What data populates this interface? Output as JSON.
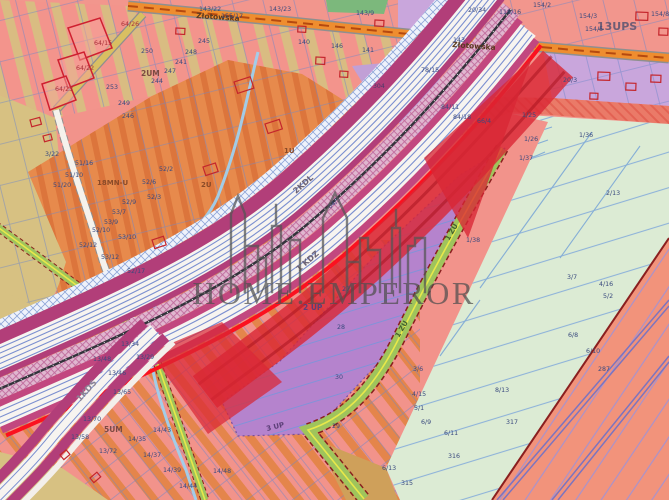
{
  "watermark": {
    "brand": "HOME.EMPEROR"
  },
  "map": {
    "street": {
      "name": "Złotowska"
    },
    "legend_colors": {
      "residential_pink": "#f2938b",
      "stripe_tan": "#d9bc82",
      "stripe_orange": "#e2823f",
      "services_orange": "#e78a4c",
      "zone_purple": "#b583cd",
      "zone_purple_light": "#c9a6dc",
      "greenery": "#dcebd4",
      "green_road": "#9fc45c",
      "agric_salmon": "#f2937b",
      "rail_magenta": "#b23e79",
      "road_white": "#f7f4f0",
      "planned_red": "#d92734",
      "street_orange": "#ef8d2f",
      "parcel_blue": "#6e86c8",
      "tan_zone": "#d7c182"
    },
    "zone_labels": [
      {
        "t": "13UPS",
        "x": 597,
        "y": 30,
        "s": 11,
        "c": "#6f5d75",
        "b": 1
      },
      {
        "t": "2UM",
        "x": 141,
        "y": 76,
        "s": 7.5,
        "c": "#7c4a42",
        "b": 1
      },
      {
        "t": "5UM",
        "x": 104,
        "y": 432,
        "s": 7.5,
        "c": "#7c4a42",
        "b": 1
      },
      {
        "t": "18MN-U",
        "x": 97,
        "y": 185,
        "s": 7,
        "c": "#8a4a28",
        "b": 1
      },
      {
        "t": "1U",
        "x": 284,
        "y": 153,
        "s": 7,
        "c": "#8a4a28",
        "b": 1
      },
      {
        "t": "2U",
        "x": 201,
        "y": 187,
        "s": 7,
        "c": "#8a4a28",
        "b": 1
      },
      {
        "t": "2 UP",
        "x": 303,
        "y": 310,
        "s": 7.5,
        "c": "#5c3f78",
        "b": 1
      },
      {
        "t": "3 UP",
        "x": 267,
        "y": 431,
        "s": 7,
        "c": "#5c3f78",
        "b": 1,
        "r": -14
      },
      {
        "t": "304",
        "x": 373,
        "y": 88,
        "s": 6.2,
        "c": "#4a3a6a"
      },
      {
        "t": "2KDL",
        "x": 296,
        "y": 194,
        "s": 8,
        "c": "#6b6275",
        "b": 1,
        "r": -41
      },
      {
        "t": "1 KDZ",
        "x": 299,
        "y": 272,
        "s": 8,
        "c": "#6b6275",
        "b": 1,
        "r": -41
      },
      {
        "t": "1KDS",
        "x": 80,
        "y": 402,
        "s": 8.5,
        "c": "#8a8494",
        "b": 1,
        "r": -48
      },
      {
        "t": "1 ZU",
        "x": 449,
        "y": 241,
        "s": 7,
        "c": "#44622e",
        "b": 1,
        "r": -60
      },
      {
        "t": "1 ZU",
        "x": 399,
        "y": 338,
        "s": 7,
        "c": "#44622e",
        "b": 1,
        "r": -60
      },
      {
        "t": "Złotowska",
        "x": 196,
        "y": 18,
        "s": 7.5,
        "c": "#5a3a20",
        "r": 4,
        "b": 1
      },
      {
        "t": "Złotowska",
        "x": 452,
        "y": 47,
        "s": 7.5,
        "c": "#5a3a20",
        "r": 4,
        "b": 1
      }
    ],
    "parcel_labels": [
      {
        "t": "64/26",
        "x": 121,
        "y": 26,
        "c": "#a83038"
      },
      {
        "t": "64/15",
        "x": 94,
        "y": 45,
        "c": "#a83038"
      },
      {
        "t": "64/22",
        "x": 76,
        "y": 70,
        "c": "#a83038"
      },
      {
        "t": "64/23",
        "x": 55,
        "y": 91,
        "c": "#a83038"
      },
      {
        "t": "250",
        "x": 141,
        "y": 53
      },
      {
        "t": "245",
        "x": 198,
        "y": 43
      },
      {
        "t": "248",
        "x": 185,
        "y": 54
      },
      {
        "t": "241",
        "x": 175,
        "y": 64
      },
      {
        "t": "247",
        "x": 164,
        "y": 73
      },
      {
        "t": "244",
        "x": 151,
        "y": 83
      },
      {
        "t": "253",
        "x": 106,
        "y": 89
      },
      {
        "t": "249",
        "x": 118,
        "y": 105
      },
      {
        "t": "246",
        "x": 122,
        "y": 118
      },
      {
        "t": "143/22",
        "x": 199,
        "y": 11
      },
      {
        "t": "143/23",
        "x": 269,
        "y": 11
      },
      {
        "t": "155/17",
        "x": 221,
        "y": 18
      },
      {
        "t": "143/9",
        "x": 356,
        "y": 15
      },
      {
        "t": "20/34",
        "x": 468,
        "y": 12
      },
      {
        "t": "118/16",
        "x": 499,
        "y": 14
      },
      {
        "t": "154/2",
        "x": 533,
        "y": 7
      },
      {
        "t": "154/3",
        "x": 579,
        "y": 18
      },
      {
        "t": "154/5",
        "x": 585,
        "y": 31
      },
      {
        "t": "154/8",
        "x": 651,
        "y": 16
      },
      {
        "t": "140",
        "x": 298,
        "y": 44
      },
      {
        "t": "146",
        "x": 331,
        "y": 48
      },
      {
        "t": "141",
        "x": 362,
        "y": 52
      },
      {
        "t": "143",
        "x": 453,
        "y": 42
      },
      {
        "t": "78/15",
        "x": 421,
        "y": 72
      },
      {
        "t": "84/18",
        "x": 453,
        "y": 119
      },
      {
        "t": "84/11",
        "x": 441,
        "y": 109
      },
      {
        "t": "66/4",
        "x": 477,
        "y": 123
      },
      {
        "t": "20/3",
        "x": 563,
        "y": 82
      },
      {
        "t": "84/5",
        "x": 330,
        "y": 209,
        "r": -41
      },
      {
        "t": "1/25",
        "x": 522,
        "y": 117
      },
      {
        "t": "1/26",
        "x": 524,
        "y": 141
      },
      {
        "t": "1/37",
        "x": 519,
        "y": 160
      },
      {
        "t": "1/36",
        "x": 579,
        "y": 137
      },
      {
        "t": "2/13",
        "x": 606,
        "y": 195
      },
      {
        "t": "1/38",
        "x": 466,
        "y": 242
      },
      {
        "t": "3/7",
        "x": 567,
        "y": 279
      },
      {
        "t": "4/16",
        "x": 599,
        "y": 286
      },
      {
        "t": "5/2",
        "x": 603,
        "y": 298
      },
      {
        "t": "6/8",
        "x": 568,
        "y": 337
      },
      {
        "t": "6/10",
        "x": 586,
        "y": 353
      },
      {
        "t": "287",
        "x": 598,
        "y": 371
      },
      {
        "t": "3/6",
        "x": 413,
        "y": 371
      },
      {
        "t": "4/15",
        "x": 412,
        "y": 396
      },
      {
        "t": "5/1",
        "x": 414,
        "y": 410
      },
      {
        "t": "6/9",
        "x": 421,
        "y": 424
      },
      {
        "t": "6/11",
        "x": 444,
        "y": 435
      },
      {
        "t": "317",
        "x": 506,
        "y": 424
      },
      {
        "t": "316",
        "x": 448,
        "y": 458
      },
      {
        "t": "315",
        "x": 401,
        "y": 485
      },
      {
        "t": "6/13",
        "x": 382,
        "y": 470
      },
      {
        "t": "8/13",
        "x": 495,
        "y": 392
      },
      {
        "t": "27",
        "x": 342,
        "y": 291
      },
      {
        "t": "28",
        "x": 337,
        "y": 329
      },
      {
        "t": "30",
        "x": 335,
        "y": 379
      },
      {
        "t": "29",
        "x": 332,
        "y": 428
      },
      {
        "t": "13/46",
        "x": 108,
        "y": 375
      },
      {
        "t": "13/65",
        "x": 113,
        "y": 394
      },
      {
        "t": "13/48",
        "x": 93,
        "y": 361
      },
      {
        "t": "13/70",
        "x": 83,
        "y": 421
      },
      {
        "t": "13/72",
        "x": 99,
        "y": 453
      },
      {
        "t": "13/58",
        "x": 71,
        "y": 439
      },
      {
        "t": "14/43",
        "x": 153,
        "y": 432
      },
      {
        "t": "14/35",
        "x": 128,
        "y": 441
      },
      {
        "t": "14/37",
        "x": 143,
        "y": 457
      },
      {
        "t": "14/39",
        "x": 163,
        "y": 472
      },
      {
        "t": "14/44",
        "x": 179,
        "y": 488
      },
      {
        "t": "14/48",
        "x": 213,
        "y": 473
      },
      {
        "t": "13/34",
        "x": 121,
        "y": 346
      },
      {
        "t": "13/29",
        "x": 136,
        "y": 359
      },
      {
        "t": "52/2",
        "x": 159,
        "y": 171
      },
      {
        "t": "52/6",
        "x": 142,
        "y": 184
      },
      {
        "t": "52/3",
        "x": 147,
        "y": 199
      },
      {
        "t": "52/9",
        "x": 122,
        "y": 204
      },
      {
        "t": "53/7",
        "x": 112,
        "y": 214
      },
      {
        "t": "53/9",
        "x": 104,
        "y": 224
      },
      {
        "t": "52/10",
        "x": 92,
        "y": 232
      },
      {
        "t": "53/10",
        "x": 118,
        "y": 239
      },
      {
        "t": "52/12",
        "x": 79,
        "y": 247
      },
      {
        "t": "53/12",
        "x": 101,
        "y": 259
      },
      {
        "t": "52/17",
        "x": 127,
        "y": 273
      },
      {
        "t": "51/16",
        "x": 75,
        "y": 165
      },
      {
        "t": "51/10",
        "x": 65,
        "y": 177
      },
      {
        "t": "51/20",
        "x": 53,
        "y": 187
      },
      {
        "t": "3/22",
        "x": 45,
        "y": 156
      }
    ],
    "buildings": [
      {
        "x": 234,
        "y": 82,
        "w": 17,
        "h": 12,
        "r": -18
      },
      {
        "x": 265,
        "y": 124,
        "w": 15,
        "h": 10,
        "r": -18
      },
      {
        "x": 203,
        "y": 167,
        "w": 13,
        "h": 9,
        "r": -18
      },
      {
        "x": 152,
        "y": 240,
        "w": 12,
        "h": 9,
        "r": -18
      },
      {
        "x": 176,
        "y": 28,
        "w": 9,
        "h": 6,
        "r": 3
      },
      {
        "x": 298,
        "y": 26,
        "w": 8,
        "h": 6,
        "r": 3
      },
      {
        "x": 375,
        "y": 20,
        "w": 9,
        "h": 6,
        "r": 3
      },
      {
        "x": 316,
        "y": 57,
        "w": 9,
        "h": 7,
        "r": 3
      },
      {
        "x": 340,
        "y": 71,
        "w": 8,
        "h": 6,
        "r": 3
      },
      {
        "x": 598,
        "y": 72,
        "w": 12,
        "h": 8,
        "r": 2
      },
      {
        "x": 626,
        "y": 83,
        "w": 10,
        "h": 7,
        "r": 2
      },
      {
        "x": 651,
        "y": 75,
        "w": 10,
        "h": 7,
        "r": 2
      },
      {
        "x": 590,
        "y": 93,
        "w": 8,
        "h": 6,
        "r": 2
      },
      {
        "x": 636,
        "y": 12,
        "w": 12,
        "h": 8,
        "r": 2
      },
      {
        "x": 659,
        "y": 28,
        "w": 9,
        "h": 7,
        "r": 2
      },
      {
        "x": 30,
        "y": 120,
        "w": 10,
        "h": 7,
        "r": -15
      },
      {
        "x": 43,
        "y": 136,
        "w": 8,
        "h": 6,
        "r": -15
      },
      {
        "x": 90,
        "y": 478,
        "w": 9,
        "h": 6,
        "r": -40
      },
      {
        "x": 60,
        "y": 455,
        "w": 8,
        "h": 6,
        "r": -40
      }
    ]
  }
}
